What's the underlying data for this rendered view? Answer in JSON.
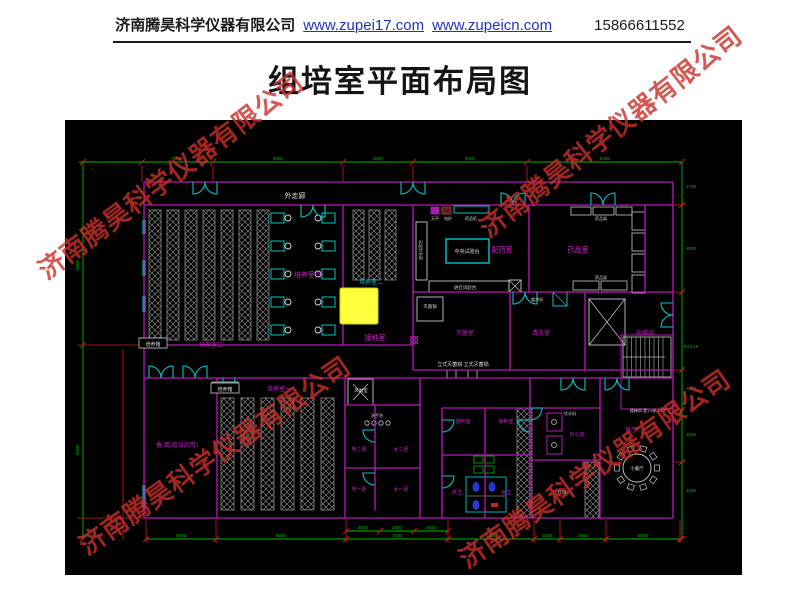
{
  "header": {
    "company": "济南腾昊科学仪器有限公司",
    "link1": "www.zupei17.com",
    "link2": "www.zupeicn.com",
    "phone": "15866611552"
  },
  "title": "组培室平面布局图",
  "watermark": {
    "text": "济南腾昊科学仪器有限公司",
    "color": "#c93028"
  },
  "plan": {
    "colors": {
      "wall": "#b818b8",
      "door": "#00c8c8",
      "dim": "#00bb00",
      "tick": "#cc1a1a",
      "furniture": "#c8c8c8",
      "room_label": "#cc1ecc",
      "highlight": "#ffff3d"
    },
    "labels": [
      {
        "t": "外走廊",
        "x": 230,
        "y": 78,
        "c": "#d8d8d8",
        "s": 7
      },
      {
        "t": "培养室三",
        "x": 243,
        "y": 157,
        "c": "#cc1ecc",
        "s": 7
      },
      {
        "t": "培养室二",
        "x": 306,
        "y": 164,
        "c": "#00c8c8",
        "s": 6
      },
      {
        "t": "接种室",
        "x": 310,
        "y": 220,
        "c": "#cc1ecc",
        "s": 7
      },
      {
        "t": "培养箱",
        "x": 88,
        "y": 226,
        "c": "#d8d8d8",
        "s": 5,
        "box": 1
      },
      {
        "t": "培养室二",
        "x": 146,
        "y": 227,
        "c": "#cc1ecc",
        "s": 6
      },
      {
        "t": "培养箱",
        "x": 160,
        "y": 271,
        "c": "#d8d8d8",
        "s": 5,
        "box": 1
      },
      {
        "t": "培养室一",
        "x": 214,
        "y": 271,
        "c": "#cc1ecc",
        "s": 6
      },
      {
        "t": "备 用(组培间用)",
        "x": 112,
        "y": 327,
        "c": "#cc1ecc",
        "s": 6
      },
      {
        "t": "风淋室",
        "x": 296,
        "y": 272,
        "c": "#d8d8d8",
        "s": 4.5
      },
      {
        "t": "洗手池",
        "x": 312,
        "y": 297,
        "c": "#d8d8d8",
        "s": 4
      },
      {
        "t": "男二更",
        "x": 294,
        "y": 331,
        "c": "#cc1ecc",
        "s": 5
      },
      {
        "t": "女二更",
        "x": 336,
        "y": 331,
        "c": "#cc1ecc",
        "s": 5
      },
      {
        "t": "男一更",
        "x": 294,
        "y": 371,
        "c": "#cc1ecc",
        "s": 5
      },
      {
        "t": "女一更",
        "x": 336,
        "y": 371,
        "c": "#cc1ecc",
        "s": 5
      },
      {
        "t": "配药室",
        "x": 437,
        "y": 132,
        "c": "#cc1ecc",
        "s": 7
      },
      {
        "t": "药品室",
        "x": 513,
        "y": 132,
        "c": "#cc1ecc",
        "s": 7
      },
      {
        "t": "中央试验台",
        "x": 402,
        "y": 133,
        "c": "#d8d8d8",
        "s": 5
      },
      {
        "t": "进仓试验台",
        "x": 357,
        "y": 130,
        "c": "#d8d8d8",
        "s": 4,
        "v": 1
      },
      {
        "t": "进仓试验台",
        "x": 400,
        "y": 169,
        "c": "#d8d8d8",
        "s": 4.5
      },
      {
        "t": "天平",
        "x": 370,
        "y": 100,
        "c": "#d8d8d8",
        "s": 4
      },
      {
        "t": "电炉",
        "x": 383,
        "y": 100,
        "c": "#d8d8d8",
        "s": 4
      },
      {
        "t": "药品柜",
        "x": 406,
        "y": 100,
        "c": "#d8d8d8",
        "s": 4
      },
      {
        "t": "药品架",
        "x": 536,
        "y": 100,
        "c": "#d8d8d8",
        "s": 4
      },
      {
        "t": "药品架",
        "x": 536,
        "y": 159,
        "c": "#d8d8d8",
        "s": 4
      },
      {
        "t": "灭菌锅",
        "x": 365,
        "y": 188,
        "c": "#d8d8d8",
        "s": 4.5
      },
      {
        "t": "灭菌室",
        "x": 400,
        "y": 215,
        "c": "#cc1ecc",
        "s": 6
      },
      {
        "t": "清洗室",
        "x": 476,
        "y": 215,
        "c": "#cc1ecc",
        "s": 6
      },
      {
        "t": "缓冲间",
        "x": 472,
        "y": 181,
        "c": "#d8d8d8",
        "s": 4
      },
      {
        "t": "电梯间",
        "x": 580,
        "y": 215,
        "c": "#cc1ecc",
        "s": 6
      },
      {
        "t": "立式灭菌锅 立式灭菌锅",
        "x": 398,
        "y": 246,
        "c": "#d8d8d8",
        "s": 5
      },
      {
        "t": "接种室",
        "x": 398,
        "y": 303,
        "c": "#cc1ecc",
        "s": 5
      },
      {
        "t": "接种室",
        "x": 441,
        "y": 303,
        "c": "#cc1ecc",
        "s": 5
      },
      {
        "t": "办公室",
        "x": 512,
        "y": 316,
        "c": "#cc1ecc",
        "s": 5
      },
      {
        "t": "饮水机",
        "x": 505,
        "y": 295,
        "c": "#d8d8d8",
        "s": 4
      },
      {
        "t": "男卫",
        "x": 392,
        "y": 374,
        "c": "#cc1ecc",
        "s": 5
      },
      {
        "t": "女卫",
        "x": 441,
        "y": 374,
        "c": "#cc1ecc",
        "s": 5
      },
      {
        "t": "仓库",
        "x": 497,
        "y": 374,
        "c": "#d8d8d8",
        "s": 5
      },
      {
        "t": "小餐厅",
        "x": 572,
        "y": 350,
        "c": "#d8d8d8",
        "s": 4.5
      },
      {
        "t": "餐厅",
        "x": 566,
        "y": 312,
        "c": "#cc1ecc",
        "s": 6
      },
      {
        "t": "楼梯间 宽1.5米 24步",
        "x": 583,
        "y": 292,
        "c": "#d8d8d8",
        "s": 4
      }
    ],
    "dims": [
      {
        "t": "5000",
        "x": 112,
        "y": 40
      },
      {
        "t": "9000",
        "x": 213,
        "y": 40
      },
      {
        "t": "5000",
        "x": 313,
        "y": 40
      },
      {
        "t": "6000",
        "x": 405,
        "y": 40
      },
      {
        "t": "8400",
        "x": 540,
        "y": 40
      },
      {
        "t": "5000",
        "x": 116,
        "y": 417
      },
      {
        "t": "9000",
        "x": 216,
        "y": 417
      },
      {
        "t": "7500",
        "x": 332,
        "y": 417
      },
      {
        "t": "6000",
        "x": 426,
        "y": 417
      },
      {
        "t": "1500",
        "x": 482,
        "y": 417
      },
      {
        "t": "2500",
        "x": 518,
        "y": 417
      },
      {
        "t": "5000",
        "x": 578,
        "y": 417
      },
      {
        "t": "2500",
        "x": 298,
        "y": 409
      },
      {
        "t": "2500",
        "x": 332,
        "y": 409
      },
      {
        "t": "2500",
        "x": 366,
        "y": 409
      },
      {
        "t": "5000",
        "x": 14,
        "y": 145,
        "v": 1
      },
      {
        "t": "5000",
        "x": 14,
        "y": 330,
        "v": 1
      },
      {
        "t": "2700",
        "x": 626,
        "y": 68
      },
      {
        "t": "6000",
        "x": 626,
        "y": 130
      },
      {
        "t": "R24.16",
        "x": 626,
        "y": 228
      },
      {
        "t": "2000",
        "x": 626,
        "y": 270
      },
      {
        "t": "4000",
        "x": 626,
        "y": 316
      },
      {
        "t": "4000",
        "x": 626,
        "y": 372
      }
    ]
  }
}
